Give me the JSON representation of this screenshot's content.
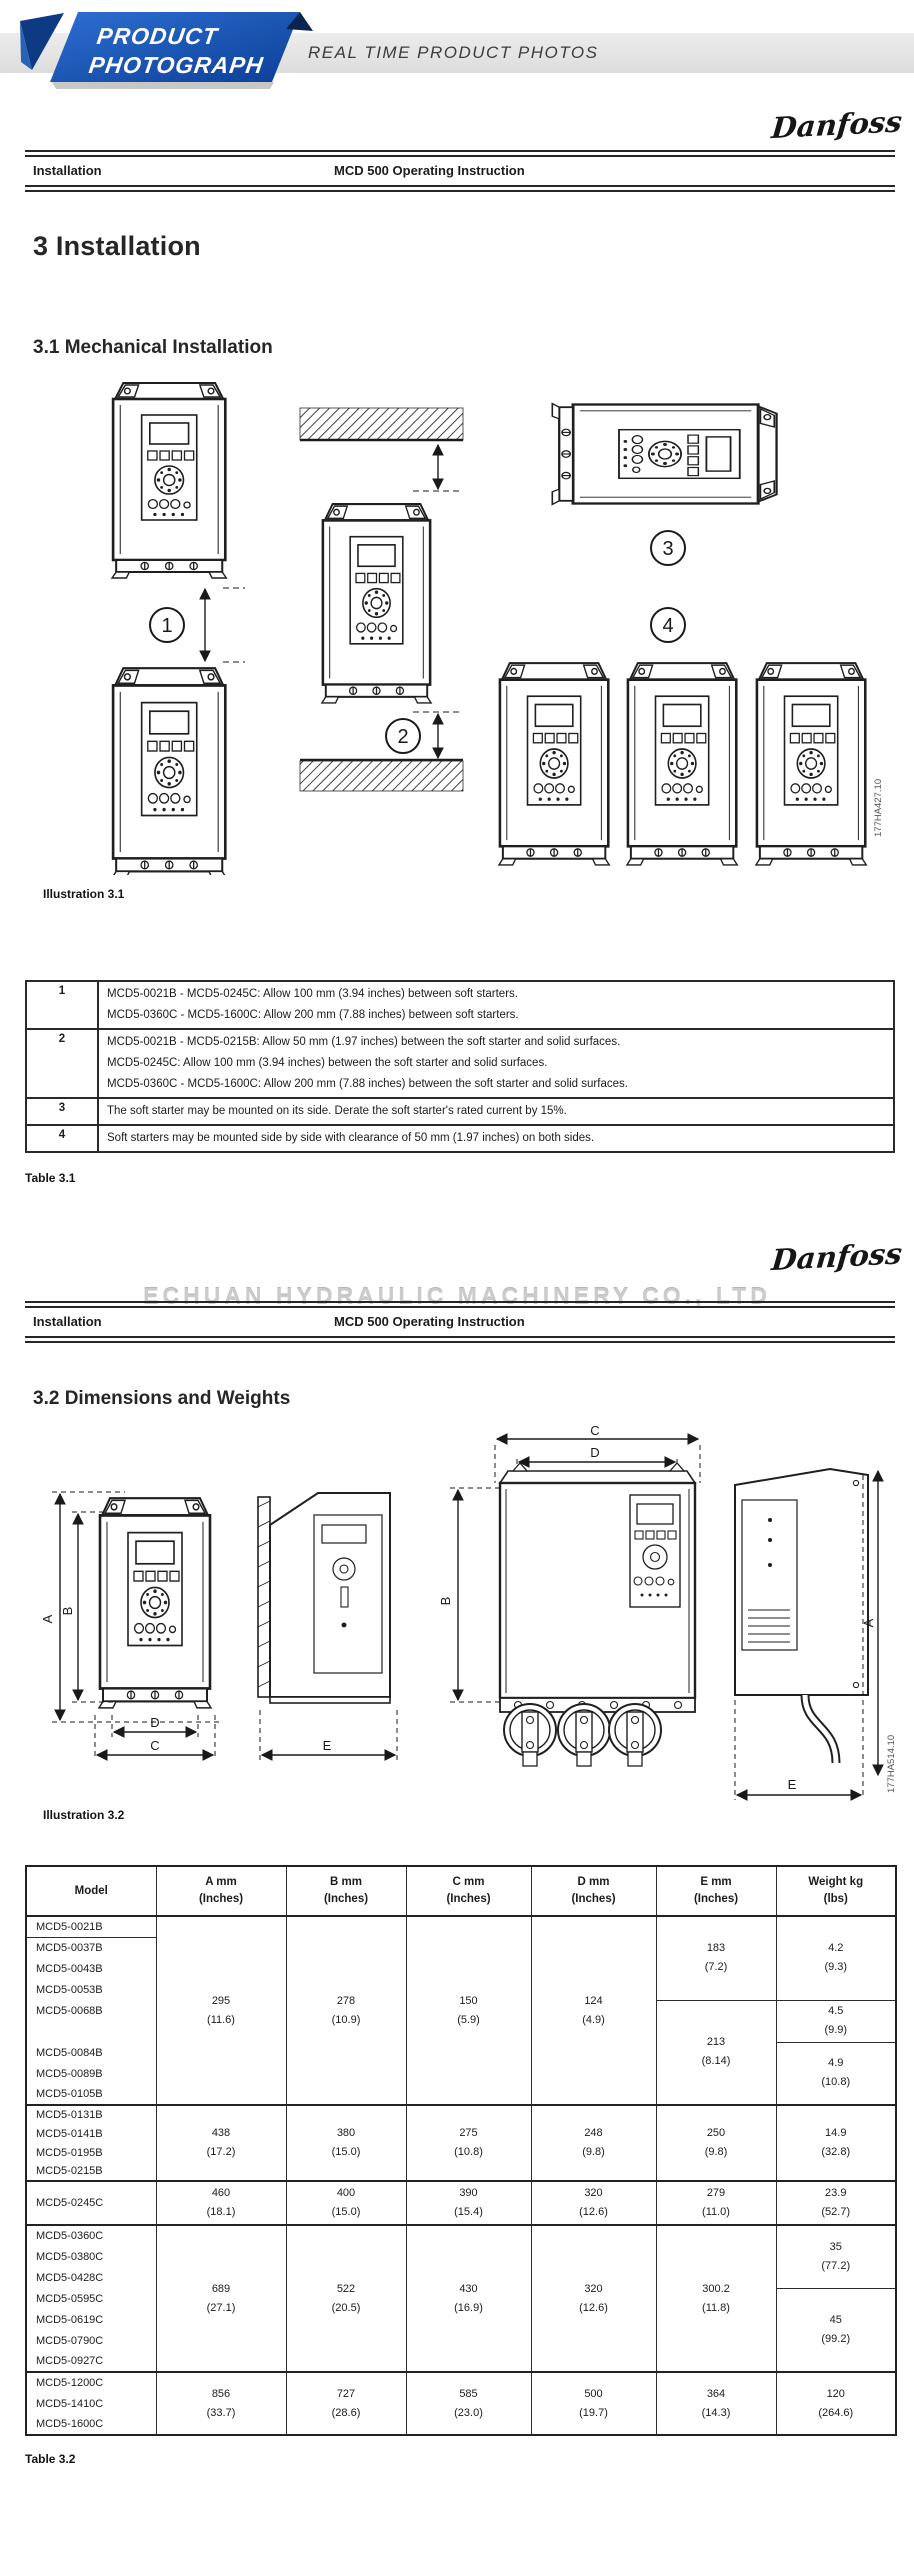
{
  "banner": {
    "ribbon_line1": "PRODUCT",
    "ribbon_line2": "PHOTOGRAPH",
    "strip_text": "REAL TIME PRODUCT PHOTOS",
    "ribbon_blue": "#1b5fc4",
    "ribbon_navy": "#0a2a5e",
    "strip_bg": "#e6e6e6"
  },
  "brand": "Danfoss",
  "p1": {
    "header": {
      "left": "Installation",
      "center": "MCD 500 Operating Instruction"
    },
    "h1": "3 Installation",
    "h2": "3.1 Mechanical Installation",
    "illus": {
      "caption": "Illustration 3.1",
      "code": "177HA427.10",
      "c1": "1",
      "c2": "2",
      "c3": "3",
      "c4": "4"
    },
    "t1": {
      "caption": "Table 3.1",
      "rows": [
        {
          "n": "1",
          "lines": [
            "MCD5-0021B - MCD5-0245C: Allow 100 mm (3.94 inches) between soft starters.",
            "MCD5-0360C - MCD5-1600C: Allow 200 mm (7.88 inches) between soft starters."
          ]
        },
        {
          "n": "2",
          "lines": [
            "MCD5-0021B - MCD5-0215B: Allow 50 mm (1.97 inches) between the soft starter and solid surfaces.",
            "MCD5-0245C: Allow 100 mm (3.94 inches) between the soft starter and solid surfaces.",
            "MCD5-0360C - MCD5-1600C: Allow 200 mm (7.88 inches) between the soft starter and solid surfaces."
          ]
        },
        {
          "n": "3",
          "lines": [
            "The soft starter may be mounted on its side. Derate the soft starter's rated current by 15%."
          ]
        },
        {
          "n": "4",
          "lines": [
            "Soft starters may be mounted side by side with clearance of 50 mm (1.97 inches) on both sides."
          ]
        }
      ]
    }
  },
  "p2": {
    "watermark": "ECHUAN HYDRAULIC MACHINERY CO., LTD",
    "header": {
      "left": "Installation",
      "center": "MCD 500 Operating Instruction"
    },
    "h2": "3.2 Dimensions and Weights",
    "illus": {
      "caption": "Illustration 3.2",
      "code": "177HA514.10",
      "dims": {
        "a": "A",
        "b": "B",
        "c": "C",
        "d": "D",
        "e": "E"
      }
    },
    "t2": {
      "caption": "Table 3.2",
      "h_model": "Model",
      "h": [
        "A mm",
        "B mm",
        "C mm",
        "D mm",
        "E mm",
        "Weight kg"
      ],
      "h2": [
        "(Inches)",
        "(Inches)",
        "(Inches)",
        "(Inches)",
        "(Inches)",
        "(lbs)"
      ],
      "g1_models": [
        "MCD5-0021B",
        "MCD5-0037B",
        "MCD5-0043B",
        "MCD5-0053B",
        "MCD5-0068B",
        "",
        "MCD5-0084B",
        "MCD5-0089B",
        "MCD5-0105B"
      ],
      "g1": {
        "a": [
          "295",
          "(11.6)"
        ],
        "b": [
          "278",
          "(10.9)"
        ],
        "c": [
          "150",
          "(5.9)"
        ],
        "d": [
          "124",
          "(4.9)"
        ],
        "e1": [
          "183",
          "(7.2)"
        ],
        "e2": [
          "213",
          "(8.14)"
        ],
        "w1": [
          "4.2",
          "(9.3)"
        ],
        "w2": [
          "4.5",
          "(9.9)"
        ],
        "w3": [
          "4.9",
          "(10.8)"
        ]
      },
      "g2_models": [
        "MCD5-0131B",
        "MCD5-0141B",
        "MCD5-0195B",
        "MCD5-0215B"
      ],
      "g2": {
        "a": [
          "438",
          "(17.2)"
        ],
        "b": [
          "380",
          "(15.0)"
        ],
        "c": [
          "275",
          "(10.8)"
        ],
        "d": [
          "248",
          "(9.8)"
        ],
        "e": [
          "250",
          "(9.8)"
        ],
        "w": [
          "14.9",
          "(32.8)"
        ]
      },
      "g3_models": [
        "MCD5-0245C"
      ],
      "g3": {
        "a": [
          "460",
          "(18.1)"
        ],
        "b": [
          "400",
          "(15.0)"
        ],
        "c": [
          "390",
          "(15.4)"
        ],
        "d": [
          "320",
          "(12.6)"
        ],
        "e": [
          "279",
          "(11.0)"
        ],
        "w": [
          "23.9",
          "(52.7)"
        ]
      },
      "g4_models": [
        "MCD5-0360C",
        "MCD5-0380C",
        "MCD5-0428C",
        "MCD5-0595C",
        "MCD5-0619C",
        "MCD5-0790C",
        "MCD5-0927C"
      ],
      "g4": {
        "a": [
          "689",
          "(27.1)"
        ],
        "b": [
          "522",
          "(20.5)"
        ],
        "c": [
          "430",
          "(16.9)"
        ],
        "d": [
          "320",
          "(12.6)"
        ],
        "e": [
          "300.2",
          "(11.8)"
        ],
        "w1": [
          "35",
          "(77.2)"
        ],
        "w2": [
          "45",
          "(99.2)"
        ]
      },
      "g5_models": [
        "MCD5-1200C",
        "MCD5-1410C",
        "MCD5-1600C"
      ],
      "g5": {
        "a": [
          "856",
          "(33.7)"
        ],
        "b": [
          "727",
          "(28.6)"
        ],
        "c": [
          "585",
          "(23.0)"
        ],
        "d": [
          "500",
          "(19.7)"
        ],
        "e": [
          "364",
          "(14.3)"
        ],
        "w": [
          "120",
          "(264.6)"
        ]
      }
    }
  }
}
